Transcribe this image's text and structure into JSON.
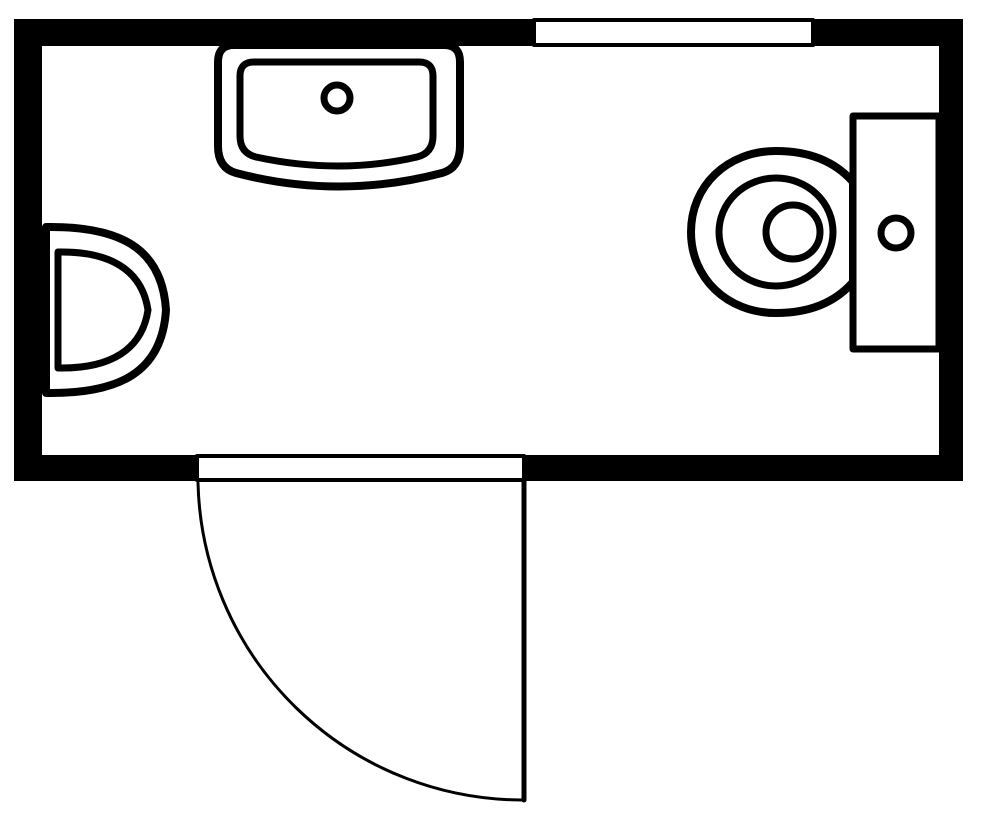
{
  "figure": {
    "type": "floorplan",
    "description": "Top-down black and white floor plan of a bathroom with sink, corner basin, toilet, window and an outward-swinging door",
    "canvas": {
      "width": 1000,
      "height": 828
    },
    "colors": {
      "wall": "#000000",
      "line": "#000000",
      "fixture_fill": "#ffffff",
      "background": "#ffffff"
    },
    "room": {
      "outer": {
        "x": 14,
        "y": 19,
        "width": 949,
        "height": 462
      },
      "interior": {
        "x": 42,
        "y": 46,
        "width": 897,
        "height": 409
      },
      "wall_thickness": {
        "top": 27,
        "left": 28,
        "right": 24,
        "bottom": 26
      }
    },
    "elements": [
      {
        "name": "wall-top",
        "type": "rect",
        "attrs": {
          "x": 14,
          "y": 19,
          "width": 949,
          "height": 27,
          "fill": "#000000"
        }
      },
      {
        "name": "wall-left",
        "type": "rect",
        "attrs": {
          "x": 14,
          "y": 19,
          "width": 28,
          "height": 462,
          "fill": "#000000"
        }
      },
      {
        "name": "wall-right",
        "type": "rect",
        "attrs": {
          "x": 939,
          "y": 19,
          "width": 24,
          "height": 462,
          "fill": "#000000"
        }
      },
      {
        "name": "wall-bottom",
        "type": "rect",
        "attrs": {
          "x": 14,
          "y": 455,
          "width": 949,
          "height": 26,
          "fill": "#000000"
        }
      },
      {
        "name": "window",
        "type": "rect",
        "attrs": {
          "x": 534,
          "y": 20,
          "width": 279,
          "height": 25,
          "fill": "#ffffff",
          "stroke": "#000000",
          "stroke-width": 4
        }
      },
      {
        "name": "door-opening",
        "type": "rect",
        "attrs": {
          "x": 197,
          "y": 456,
          "width": 327,
          "height": 24,
          "fill": "#ffffff",
          "stroke": "#000000",
          "stroke-width": 4
        }
      },
      {
        "name": "door-leaf",
        "type": "line",
        "attrs": {
          "x1": 524,
          "y1": 481,
          "x2": 524,
          "y2": 800,
          "stroke": "#000000",
          "stroke-width": 5
        }
      },
      {
        "name": "door-swing-arc",
        "type": "path",
        "attrs": {
          "d": "M 198 483 A 325 325 0 0 0 524 800",
          "fill": "none",
          "stroke": "#000000",
          "stroke-width": 3
        }
      },
      {
        "name": "sink-counter",
        "type": "path",
        "attrs": {
          "d": "M 218 62 Q 218 45 234 45 L 444 45 Q 460 45 460 62 L 460 146 Q 460 168 442 173 Q 339 200 236 173 Q 218 168 218 146 Z",
          "fill": "#ffffff",
          "stroke": "#000000",
          "stroke-width": 8
        }
      },
      {
        "name": "sink-basin",
        "type": "path",
        "attrs": {
          "d": "M 240 76 Q 240 62 254 62 L 419 62 Q 433 62 433 76 L 433 136 Q 433 153 417 157 Q 339 175 256 157 Q 240 153 240 136 Z",
          "fill": "#ffffff",
          "stroke": "#000000",
          "stroke-width": 7
        }
      },
      {
        "name": "sink-faucet",
        "type": "circle",
        "attrs": {
          "cx": 337,
          "cy": 98,
          "r": 13,
          "fill": "#ffffff",
          "stroke": "#000000",
          "stroke-width": 7
        }
      },
      {
        "name": "corner-basin-outer",
        "type": "path",
        "attrs": {
          "d": "M 46 227 C 120 226 162 248 166 310 C 162 372 120 394 46 393 Z",
          "fill": "#ffffff",
          "stroke": "#000000",
          "stroke-width": 8
        }
      },
      {
        "name": "corner-basin-inner",
        "type": "path",
        "attrs": {
          "d": "M 58 252 C 110 251 142 270 148 310 C 142 350 110 369 58 368 Z",
          "fill": "#ffffff",
          "stroke": "#000000",
          "stroke-width": 7
        }
      },
      {
        "name": "toilet-bowl",
        "type": "path",
        "attrs": {
          "d": "M 853 182 C 832 158 804 151 776 151 C 727 151 691 186 691 232 C 691 278 727 313 776 313 C 804 313 832 306 853 282 L 853 182 Z",
          "fill": "#ffffff",
          "stroke": "#000000",
          "stroke-width": 8
        }
      },
      {
        "name": "toilet-tank",
        "type": "rect",
        "attrs": {
          "x": 853,
          "y": 116,
          "width": 86,
          "height": 233,
          "fill": "#ffffff",
          "stroke": "#000000",
          "stroke-width": 7
        }
      },
      {
        "name": "toilet-seat",
        "type": "ellipse",
        "attrs": {
          "cx": 776,
          "cy": 232,
          "rx": 57,
          "ry": 54,
          "fill": "#ffffff",
          "stroke": "#000000",
          "stroke-width": 7
        }
      },
      {
        "name": "toilet-bowl-inner",
        "type": "circle",
        "attrs": {
          "cx": 793,
          "cy": 232,
          "r": 27,
          "fill": "#ffffff",
          "stroke": "#000000",
          "stroke-width": 7
        }
      },
      {
        "name": "toilet-flush-button",
        "type": "circle",
        "attrs": {
          "cx": 896,
          "cy": 233,
          "r": 15,
          "fill": "#ffffff",
          "stroke": "#000000",
          "stroke-width": 7
        }
      }
    ]
  }
}
